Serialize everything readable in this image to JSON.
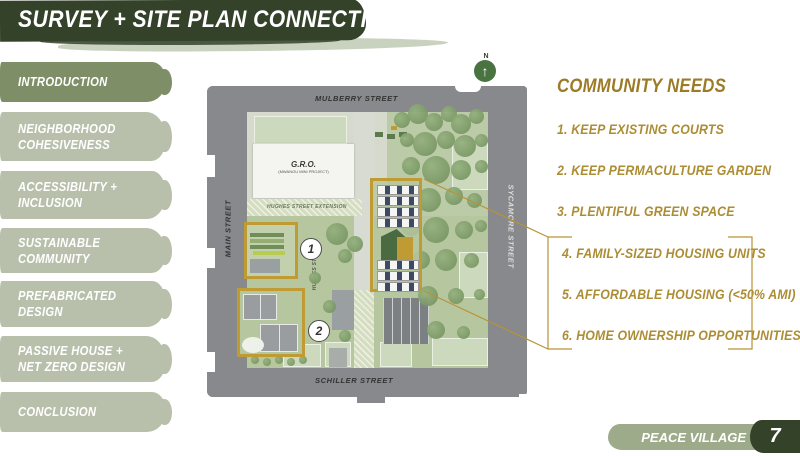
{
  "slide": {
    "title": "SURVEY + SITE PLAN CONNECTION",
    "footer_label": "PEACE VILLAGE",
    "page_number": "7",
    "colors": {
      "header_green": "#34422a",
      "sidebar_active": "#7e8e67",
      "sidebar_inactive": "#b8c0ab",
      "accent_gold": "#c09a33",
      "needs_text_gold": "#ac8d34"
    }
  },
  "sidebar": {
    "items": [
      {
        "label": "INTRODUCTION",
        "active": true
      },
      {
        "label": "NEIGHBORHOOD\nCOHESIVENESS",
        "active": false
      },
      {
        "label": "ACCESSIBILITY +\nINCLUSION",
        "active": false
      },
      {
        "label": "SUSTAINABLE\nCOMMUNITY",
        "active": false
      },
      {
        "label": "PREFABRICATED\nDESIGN",
        "active": false
      },
      {
        "label": "PASSIVE HOUSE +\nNET ZERO DESIGN",
        "active": false
      },
      {
        "label": "CONCLUSION",
        "active": false
      }
    ]
  },
  "map": {
    "compass_label": "N",
    "streets": {
      "top": "MULBERRY STREET",
      "left": "MAIN STREET",
      "right": "SYCAMORE STREET",
      "bottom": "SCHILLER STREET"
    },
    "paths": {
      "extension": "HUGHES STREET EXTENSION",
      "hughes": "HUGHES STREET"
    },
    "gro_building": {
      "name": "G.R.O.",
      "subtitle": "(MWANGU MINI PROJECT)"
    },
    "markers": [
      {
        "number": "1"
      },
      {
        "number": "2"
      }
    ]
  },
  "community_needs": {
    "heading": "COMMUNITY NEEDS",
    "items": [
      "1. KEEP EXISTING COURTS",
      "2. KEEP PERMACULTURE GARDEN",
      "3. PLENTIFUL GREEN SPACE",
      "4. FAMILY-SIZED HOUSING UNITS",
      "5. AFFORDABLE HOUSING (<50% AMI)",
      "6. HOME OWNERSHIP OPPORTUNITIES"
    ]
  }
}
